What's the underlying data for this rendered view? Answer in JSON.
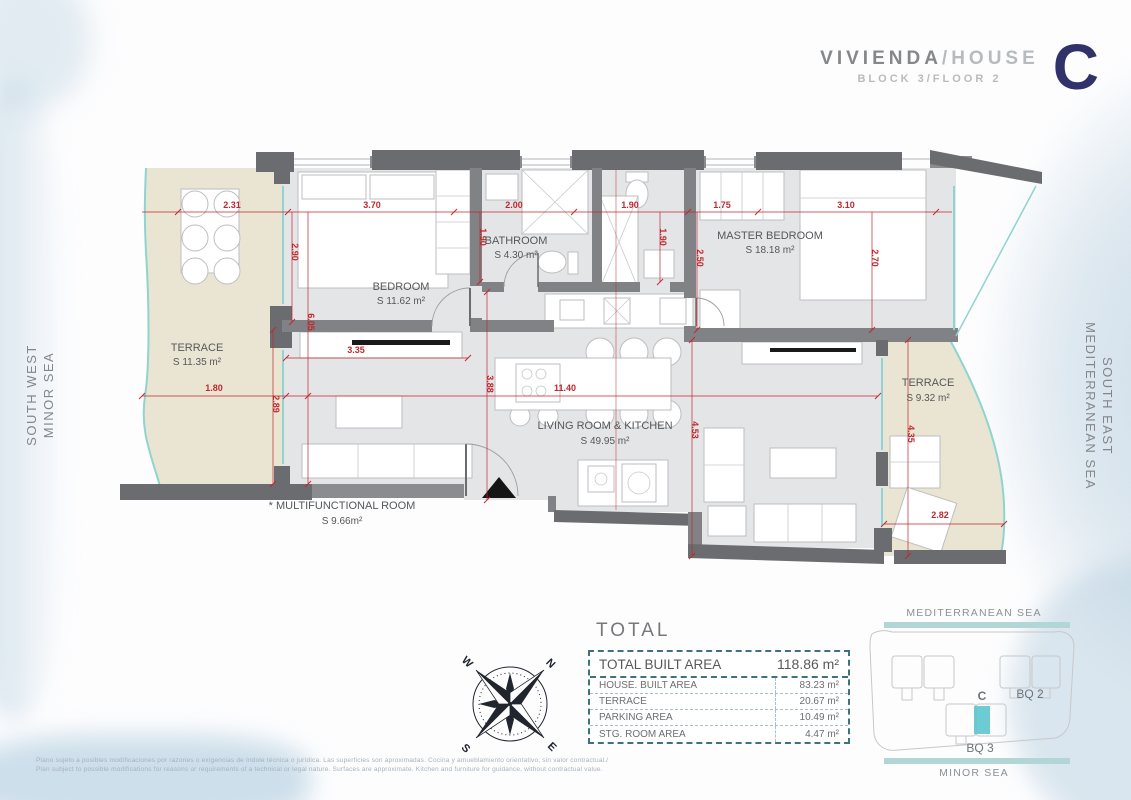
{
  "header": {
    "title_es": "VIVIENDA",
    "title_sep": "/",
    "title_en": "HOUSE",
    "subtitle": "BLOCK 3/FLOOR 2",
    "unit": "C"
  },
  "plan": {
    "rooms": {
      "terrace_left": {
        "name": "TERRACE",
        "area": "S 11.35 m²"
      },
      "bedroom": {
        "name": "BEDROOM",
        "area": "S 11.62 m²"
      },
      "bathroom": {
        "name": "BATHROOM",
        "area": "S 4.30 m²"
      },
      "master_bedroom": {
        "name": "MASTER BEDROOM",
        "area": "S 18.18 m²"
      },
      "living": {
        "name": "LIVING ROOM & KITCHEN",
        "area": "S 49.95 m²"
      },
      "terrace_right": {
        "name": "TERRACE",
        "area": "S 9.32 m²"
      },
      "multifunctional": {
        "name": "* MULTIFUNCTIONAL ROOM",
        "area": "S 9.66m²"
      }
    },
    "dims": {
      "terrace_w": "2.31",
      "bedroom_w": "3.70",
      "bath_w": "2.00",
      "hall_w": "1.90",
      "master_w1": "1.75",
      "master_w2": "3.10",
      "bedroom_h": "2.90",
      "bath_h": "1.90",
      "hall_h": "1.90",
      "master_h1": "2.50",
      "master_h2": "2.70",
      "terrace_l_h": "6.05",
      "terrace_l_w2": "1.80",
      "multi_h": "2.89",
      "shelf_w": "3.35",
      "living_w": "11.40",
      "living_h1": "3.88",
      "living_h2": "4.53",
      "terrace_r_h": "4.35",
      "terrace_r_w": "2.82"
    }
  },
  "sides": {
    "left_line1": "SOUTH WEST",
    "left_line2": "MINOR SEA",
    "right_line1": "SOUTH EAST",
    "right_line2": "MEDITERRANEAN SEA"
  },
  "compass": {
    "n": "N",
    "e": "E",
    "s": "S",
    "w": "W"
  },
  "totals": {
    "heading": "TOTAL",
    "total_row": {
      "label": "TOTAL BUILT AREA",
      "value": "118.86 m²"
    },
    "rows": [
      {
        "label": "HOUSE. BUILT AREA",
        "value": "83.23 m²"
      },
      {
        "label": "TERRACE",
        "value": "20.67 m²"
      },
      {
        "label": "PARKING AREA",
        "value": "10.49 m²"
      },
      {
        "label": "STG. ROOM AREA",
        "value": "4.47 m²"
      }
    ]
  },
  "site_map": {
    "top_sea": "MEDITERRANEAN SEA",
    "bottom_sea": "MINOR SEA",
    "block2": "BQ 2",
    "block3": "BQ 3",
    "unit": "C"
  },
  "footer": {
    "line_es": "Plano sujeto a posibles modificaciones por razones o exigencias de índole técnica o jurídica. Las superficies son aproximadas. Cocina y amueblamiento orientativo, sin valor contractual./",
    "line_en": "Plan subject to possible modifications for reasons or requirements of a technical or legal nature. Surfaces are approximate. Kitchen and furniture for guidance, without contractual value."
  },
  "colors": {
    "accent_teal": "#8fd4cf",
    "dim_red": "#c1272d",
    "wall_gray": "#77787b",
    "unit_navy": "#32326b",
    "terrace_beige": "#eae5d2"
  }
}
